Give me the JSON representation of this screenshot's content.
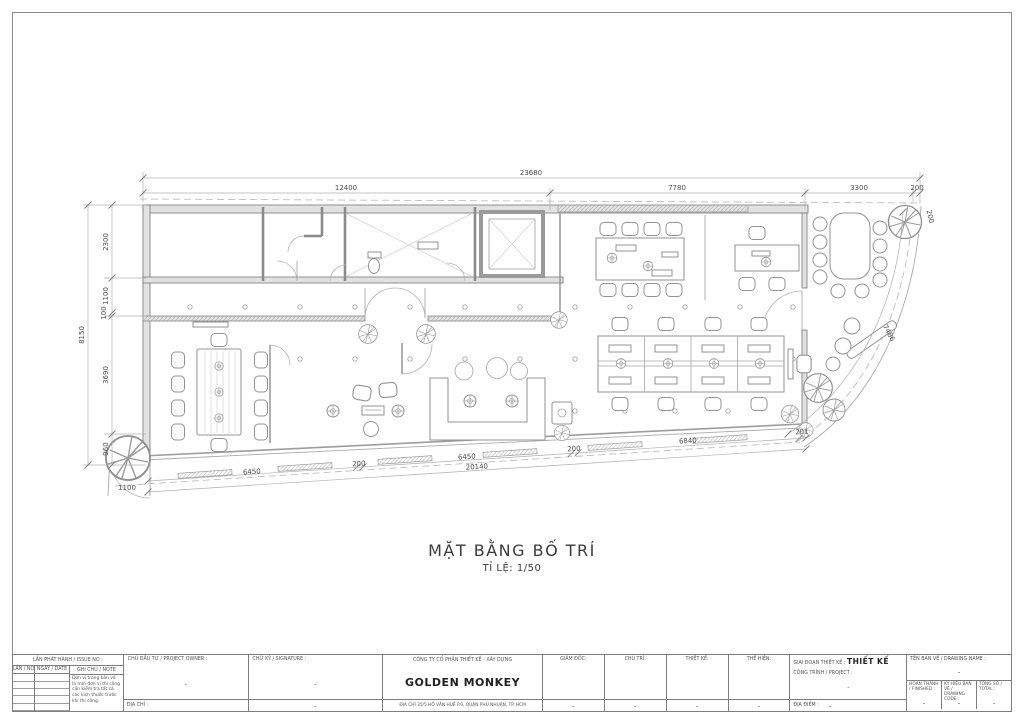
{
  "page": {
    "title": "MẶT BẰNG BỐ TRÍ",
    "scale": "TỈ LỆ: 1/50"
  },
  "dims": {
    "top_total": "23680",
    "top_segments": [
      "12400",
      "7780",
      "3300",
      "200"
    ],
    "corner_200": "200",
    "left_total": "8150",
    "left_segments": [
      "2300",
      "1100",
      "100",
      "3690",
      "960"
    ],
    "left_bottom": "1100",
    "bottom_segments": [
      "6450",
      "200",
      "6450",
      "200",
      "6840",
      "201"
    ],
    "bottom_total": "20140",
    "curve_length": "7486"
  },
  "title_block": {
    "issue_header": "LẦN PHÁT HÀNH / ISSUE NO :",
    "issue_col_no": "LẦN / NO",
    "issue_col_date": "NGÀY / DATE",
    "issue_col_note": "GHI CHÚ / NOTE",
    "issue_note": "Đơn vị trong bản vẽ là mm đơn vị thi công cần kiểm tra tất cả các kích thước trước khi thi công.",
    "owner_label": "CHỦ ĐẦU TƯ / PROJECT OWNER :",
    "owner_value": "-",
    "owner_address_label": "ĐỊA CHỈ :",
    "signature_label": "CHỮ KÝ / SIGNATURE :",
    "signature_value": "-",
    "signature_bottom_value": "-",
    "company_type": "CÔNG TY CỔ PHẦN THIẾT KẾ - XÂY DỰNG",
    "company_name": "GOLDEN MONKEY",
    "company_address": "ĐỊA CHỈ 35/5 HỒ VĂN HUÊ P.9, QUẬN PHÚ NHUẬN, TP. HCM",
    "roles": [
      {
        "label": "GIÁM ĐỐC:",
        "value": "-"
      },
      {
        "label": "CHỦ TRÌ:",
        "value": "-"
      },
      {
        "label": "THIẾT KẾ:",
        "value": "-"
      },
      {
        "label": "THỂ HIỆN:",
        "value": "-"
      }
    ],
    "stage_label": "GIAI ĐOẠN THIẾT KẾ :",
    "stage_value": "THIẾT KẾ",
    "project_label": "CÔNG TRÌNH / PROJECT :",
    "project_value": "-",
    "location_label": "ĐỊA ĐIỂM :",
    "location_value": "-",
    "drawing_name_label": "TÊN BẢN VẼ / DRAWING NAME :",
    "drawing_name_value": "-",
    "finished_label": "HOÀN THÀNH / FINISHED :",
    "finished_value": "-",
    "code_label": "KÝ HIỆU BẢN VẼ / DRAWING CODE :",
    "code_value": "-",
    "total_label": "TỔNG SỐ / TOTAL :",
    "total_value": "-"
  }
}
